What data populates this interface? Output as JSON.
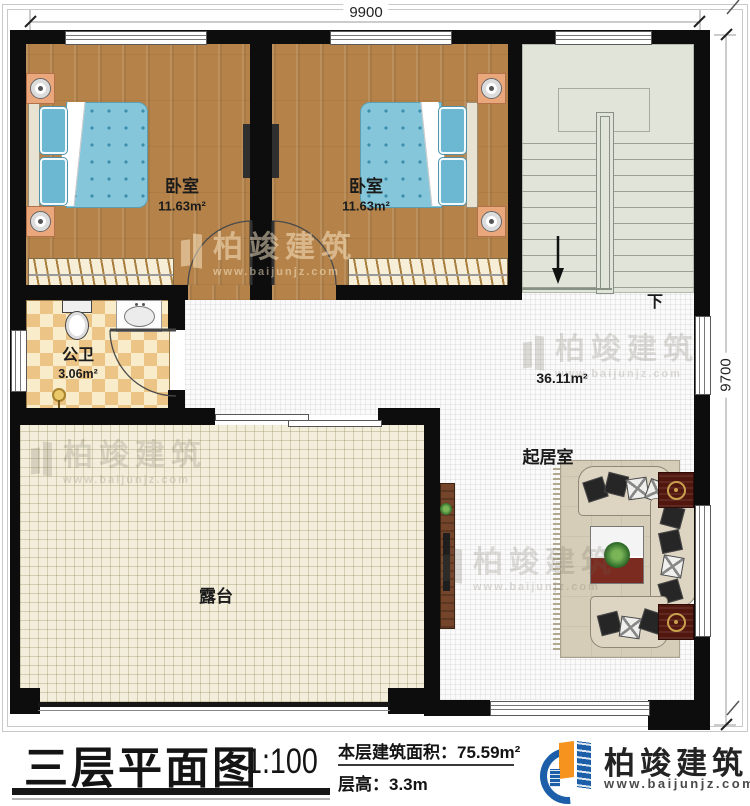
{
  "dimensions": {
    "top": "9900",
    "right": "9700"
  },
  "rooms": {
    "bedroom1": {
      "name": "卧室",
      "area": "11.63m²"
    },
    "bedroom2": {
      "name": "卧室",
      "area": "11.63m²"
    },
    "bathroom": {
      "name": "公卫",
      "area": "3.06m²"
    },
    "living": {
      "name": "起居室",
      "area": "36.11m²"
    },
    "terrace": {
      "name": "露台"
    },
    "stairs": {
      "down_label": "下"
    }
  },
  "title_block": {
    "title": "三层平面图",
    "scale": "1:100",
    "area_label": "本层建筑面积：",
    "area_value": "75.59m²",
    "height_label": "层高：",
    "height_value": "3.3m"
  },
  "branding": {
    "company": "柏竣建筑",
    "website": "www.baijunjz.com",
    "accent_blue": "#1c5fa8",
    "accent_orange": "#f6921e"
  }
}
